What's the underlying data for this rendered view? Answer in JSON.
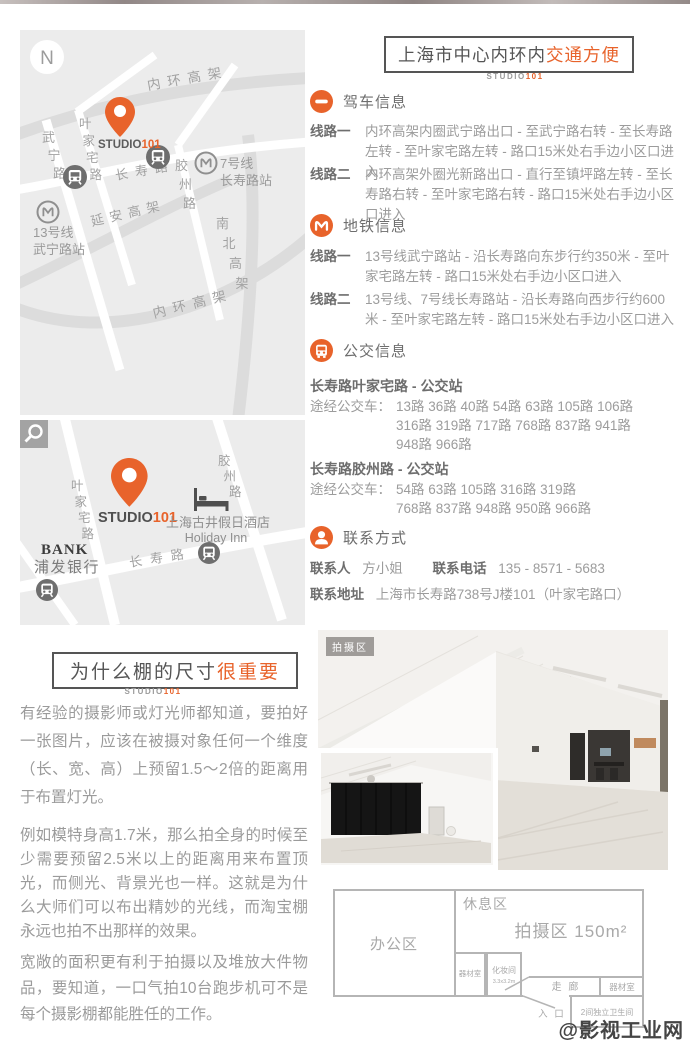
{
  "colors": {
    "accent": "#e8632b",
    "heading_gray": "#6e6e6e",
    "body_gray": "#9c9c9c",
    "map_bg": "#ececec"
  },
  "header": {
    "title_plain": "上海市中心内环内",
    "title_accent": "交通方便",
    "logo_gray": "STUDIO",
    "logo_orange": "101"
  },
  "driving": {
    "title": "驾车信息",
    "routes": [
      {
        "label": "线路一",
        "text": "内环高架内圈武宁路出口 - 至武宁路右转 - 至长寿路左转 - 至叶家宅路左转 - 路口15米处右手边小区口进入"
      },
      {
        "label": "线路二",
        "text": "内环高架外圈光新路出口 - 直行至镇坪路左转 - 至长寿路右转 - 至叶家宅路右转 - 路口15米处右手边小区口进入"
      }
    ]
  },
  "metro": {
    "title": "地铁信息",
    "routes": [
      {
        "label": "线路一",
        "text": "13号线武宁路站 - 沿长寿路向东步行约350米 - 至叶家宅路左转 - 路口15米处右手边小区口进入"
      },
      {
        "label": "线路二",
        "text": "13号线、7号线长寿路站 - 沿长寿路向西步行约600米 - 至叶家宅路左转 - 路口15米处右手边小区口进入"
      }
    ]
  },
  "bus": {
    "title": "公交信息",
    "stops": [
      {
        "name": "长寿路叶家宅路 - 公交站",
        "label": "途经公交车：",
        "lines": [
          "13路 36路 40路 54路 63路 105路 106路",
          "316路 319路 717路 768路 837路 941路",
          "948路 966路"
        ]
      },
      {
        "name": "长寿路胶州路 - 公交站",
        "label": "途经公交车：",
        "lines": [
          "54路 63路 105路 316路 319路",
          "768路 837路 948路 950路 966路"
        ]
      }
    ]
  },
  "contact": {
    "title": "联系方式",
    "person_label": "联系人",
    "person": "方小姐",
    "phone_label": "联系电话",
    "phone": "135 - 8571 - 5683",
    "addr_label": "联系地址",
    "addr": "上海市长寿路738号J楼101（叶家宅路口）"
  },
  "map1": {
    "compass": "N",
    "highway_top": "内环高架",
    "highway_bottom": "内环高架",
    "wuning_rd": "武宁路",
    "yejiazhai_rd": "叶家宅路",
    "changshou_rd": "长寿路",
    "jiaozhou_rd": "胶州路",
    "yanan_hw": "延安高架",
    "nanbei_hw": "南北高架",
    "line7": "7号线",
    "line7_station": "长寿路站",
    "line13": "13号线",
    "line13_station": "武宁路站",
    "pin_logo_gray": "STUDIO",
    "pin_logo_orange": "101"
  },
  "map2": {
    "yejiazhai_rd": "叶家宅路",
    "jiaozhou_rd": "胶州路",
    "changshou_rd": "长寿路",
    "bank_en": "BANK",
    "bank_cn": "浦发银行",
    "hotel_cn": "上海古井假日酒店",
    "hotel_en": "Holiday Inn",
    "pin_logo_gray": "STUDIO",
    "pin_logo_orange": "101"
  },
  "photo": {
    "tag": "拍摄区"
  },
  "why": {
    "title_plain": "为什么棚的尺寸",
    "title_accent": "很重要",
    "logo_gray": "STUDIO",
    "logo_orange": "101",
    "paragraphs": [
      "有经验的摄影师或灯光师都知道，要拍好一张图片，应该在被摄对象任何一个维度（长、宽、高）上预留1.5～2倍的距离用于布置灯光。",
      "例如模特身高1.7米，那么拍全身的时候至少需要预留2.5米以上的距离用来布置顶光，而侧光、背景光也一样。这就是为什么大师们可以布出精妙的光线，而淘宝棚永远也拍不出那样的效果。",
      "宽敞的面积更有利于拍摄以及堆放大件物品，要知道，一口气拍10台跑步机可不是每个摄影棚都能胜任的工作。"
    ]
  },
  "floorplan": {
    "office": "办公区",
    "rest": "休息区",
    "shoot": "拍摄区 150m²",
    "equip_left": "器材室",
    "makeup": "化妆间",
    "makeup_size": "3.3x3.2m",
    "corridor": "走 廊",
    "equip_right": "器材室",
    "entrance": "入 口",
    "toilet": "2间独立卫生间"
  },
  "watermark": "@影视工业网"
}
